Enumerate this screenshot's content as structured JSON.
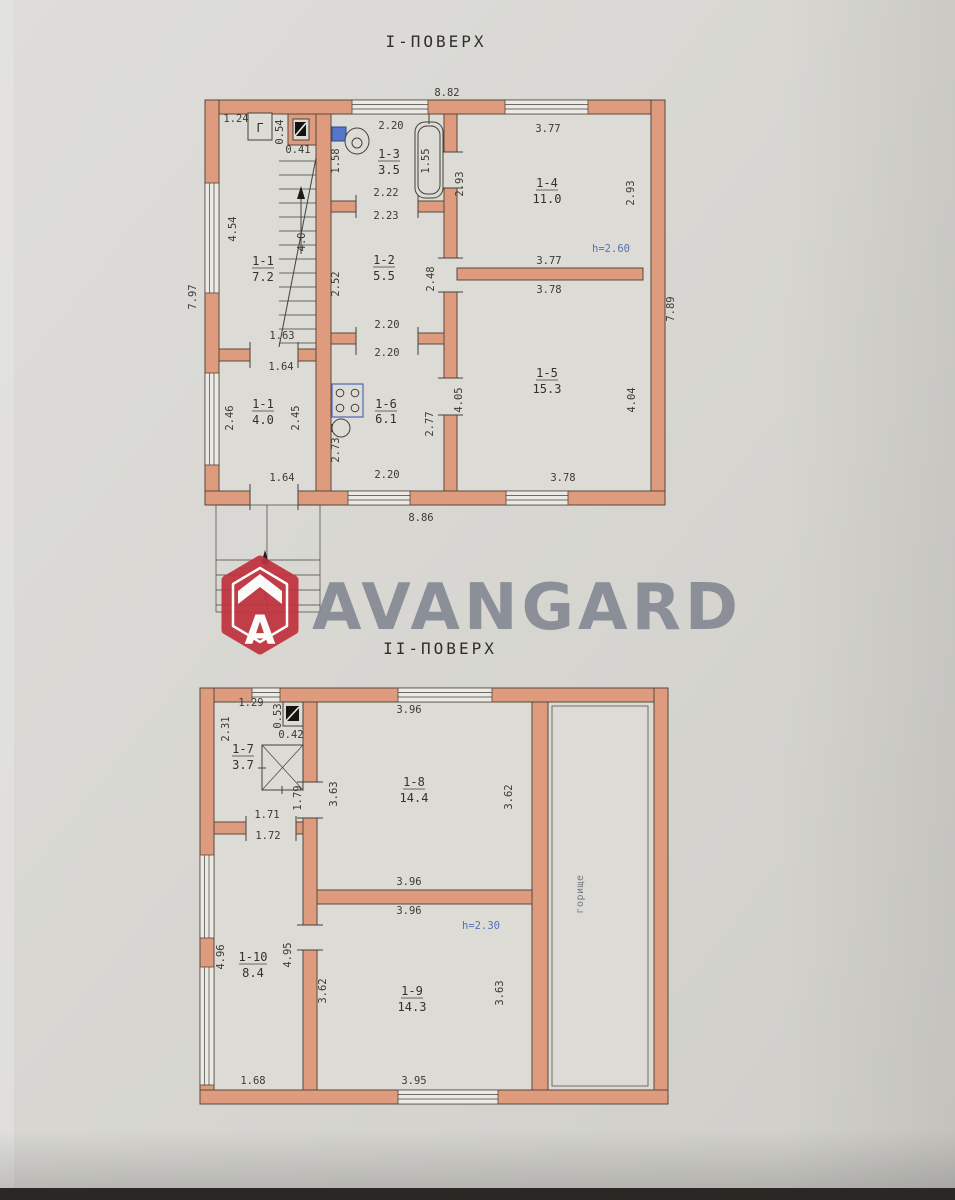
{
  "titles": {
    "floor1": "І-ПОВЕРХ",
    "floor2": "ІІ-ПОВЕРХ"
  },
  "watermark": {
    "brand": "AVANGARD",
    "logo_letter": "A"
  },
  "colors": {
    "wall_salmon": "#de9b7d",
    "paper": "#d8d7d3",
    "ink": "#3d3a35",
    "note_blue": "#5570b5",
    "brand_red": "#c0323e",
    "brand_gray": "#7b818c"
  },
  "floor1": {
    "gas_meter_label": "Г",
    "rooms": [
      {
        "id": "1-1",
        "area": "7.2"
      },
      {
        "id": "1-1",
        "area": "4.0"
      },
      {
        "id": "1-2",
        "area": "5.5"
      },
      {
        "id": "1-3",
        "area": "3.5"
      },
      {
        "id": "1-4",
        "area": "11.0"
      },
      {
        "id": "1-5",
        "area": "15.3"
      },
      {
        "id": "1-6",
        "area": "6.1"
      }
    ],
    "dims": [
      {
        "t": "8.82",
        "x": 447,
        "y": 96
      },
      {
        "t": "1.24",
        "x": 236,
        "y": 122
      },
      {
        "t": "0.54",
        "x": 283,
        "y": 132,
        "r": -90
      },
      {
        "t": "0.41",
        "x": 298,
        "y": 153
      },
      {
        "t": "2.20",
        "x": 391,
        "y": 129
      },
      {
        "t": "1.58",
        "x": 339,
        "y": 161,
        "r": -90
      },
      {
        "t": "1.55",
        "x": 429,
        "y": 161,
        "r": -90
      },
      {
        "t": "3.77",
        "x": 548,
        "y": 132
      },
      {
        "t": "2.93",
        "x": 463,
        "y": 184,
        "r": -90
      },
      {
        "t": "2.93",
        "x": 634,
        "y": 193,
        "r": -90
      },
      {
        "t": "4.54",
        "x": 236,
        "y": 229,
        "r": -90
      },
      {
        "t": "7.97",
        "x": 196,
        "y": 297,
        "r": -90
      },
      {
        "t": "2.22",
        "x": 386,
        "y": 196
      },
      {
        "t": "2.23",
        "x": 386,
        "y": 219
      },
      {
        "t": "4.0",
        "x": 305,
        "y": 242,
        "r": -90
      },
      {
        "t": "2.52",
        "x": 339,
        "y": 284,
        "r": -90
      },
      {
        "t": "2.48",
        "x": 434,
        "y": 279,
        "r": -90
      },
      {
        "t": "h=2.60",
        "x": 611,
        "y": 252,
        "c": "blue",
        "n": "height-note"
      },
      {
        "t": "3.77",
        "x": 549,
        "y": 264
      },
      {
        "t": "3.78",
        "x": 549,
        "y": 293
      },
      {
        "t": "7.89",
        "x": 674,
        "y": 309,
        "r": -90
      },
      {
        "t": "1.63",
        "x": 282,
        "y": 339
      },
      {
        "t": "1.64",
        "x": 281,
        "y": 370
      },
      {
        "t": "2.20",
        "x": 387,
        "y": 328
      },
      {
        "t": "2.20",
        "x": 387,
        "y": 356
      },
      {
        "t": "2.46",
        "x": 233,
        "y": 418,
        "r": -90
      },
      {
        "t": "2.45",
        "x": 299,
        "y": 418,
        "r": -90
      },
      {
        "t": "2.73",
        "x": 339,
        "y": 450,
        "r": -90
      },
      {
        "t": "2.77",
        "x": 433,
        "y": 424,
        "r": -90
      },
      {
        "t": "4.05",
        "x": 462,
        "y": 400,
        "r": -90
      },
      {
        "t": "4.04",
        "x": 635,
        "y": 400,
        "r": -90
      },
      {
        "t": "1.64",
        "x": 282,
        "y": 481
      },
      {
        "t": "2.20",
        "x": 387,
        "y": 478
      },
      {
        "t": "3.78",
        "x": 563,
        "y": 481
      },
      {
        "t": "8.86",
        "x": 421,
        "y": 521
      }
    ]
  },
  "floor2": {
    "rooms": [
      {
        "id": "1-7",
        "area": "3.7"
      },
      {
        "id": "1-8",
        "area": "14.4"
      },
      {
        "id": "1-9",
        "area": "14.3"
      },
      {
        "id": "1-10",
        "area": "8.4"
      }
    ],
    "dims": [
      {
        "t": "1.29",
        "x": 251,
        "y": 706
      },
      {
        "t": "0.53",
        "x": 281,
        "y": 716,
        "r": -90
      },
      {
        "t": "0.42",
        "x": 291,
        "y": 738
      },
      {
        "t": "2.31",
        "x": 229,
        "y": 729,
        "r": -90
      },
      {
        "t": "3.96",
        "x": 409,
        "y": 713
      },
      {
        "t": "1.79",
        "x": 301,
        "y": 798,
        "r": -90
      },
      {
        "t": "3.63",
        "x": 337,
        "y": 794,
        "r": -90
      },
      {
        "t": "3.62",
        "x": 512,
        "y": 797,
        "r": -90
      },
      {
        "t": "1.71",
        "x": 267,
        "y": 818
      },
      {
        "t": "1.72",
        "x": 268,
        "y": 839
      },
      {
        "t": "3.96",
        "x": 409,
        "y": 885
      },
      {
        "t": "3.96",
        "x": 409,
        "y": 914
      },
      {
        "t": "h=2.30",
        "x": 481,
        "y": 929,
        "c": "blue",
        "n": "height-note"
      },
      {
        "t": "4.96",
        "x": 224,
        "y": 957,
        "r": -90
      },
      {
        "t": "4.95",
        "x": 291,
        "y": 955,
        "r": -90
      },
      {
        "t": "3.62",
        "x": 326,
        "y": 991,
        "r": -90
      },
      {
        "t": "3.63",
        "x": 503,
        "y": 993,
        "r": -90
      },
      {
        "t": "1.68",
        "x": 253,
        "y": 1084
      },
      {
        "t": "3.95",
        "x": 414,
        "y": 1084
      },
      {
        "t": "горище",
        "x": 583,
        "y": 894,
        "r": -90,
        "c": "attic",
        "n": "attic-label"
      }
    ]
  }
}
